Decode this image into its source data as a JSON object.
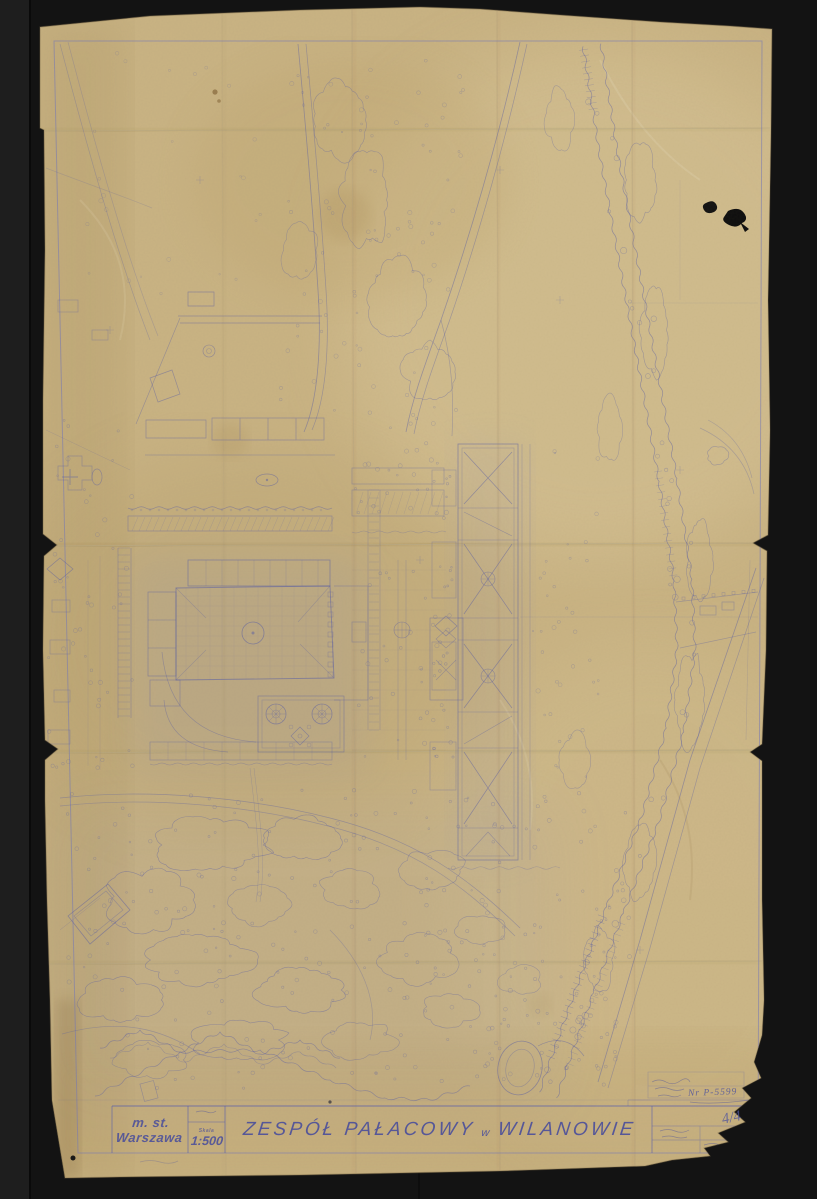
{
  "scene": {
    "description": "Archival blueprint site plan sheet photographed on a dark backdrop",
    "backdrop_color": "#141414",
    "paper_color": "#c9b383",
    "ink_color": "#575ca6"
  },
  "title_block": {
    "city_line1": "m. st.",
    "city_line2": "Warszawa",
    "scale_caption": "Skala",
    "scale_value": "1:500",
    "title_main": "ZESPÓŁ PAŁACOWY",
    "title_connector": "w",
    "title_place": "WILANOWIE"
  },
  "annotations": {
    "inventory_number": "Nr P-5599",
    "sheet_mark": "4/4"
  }
}
